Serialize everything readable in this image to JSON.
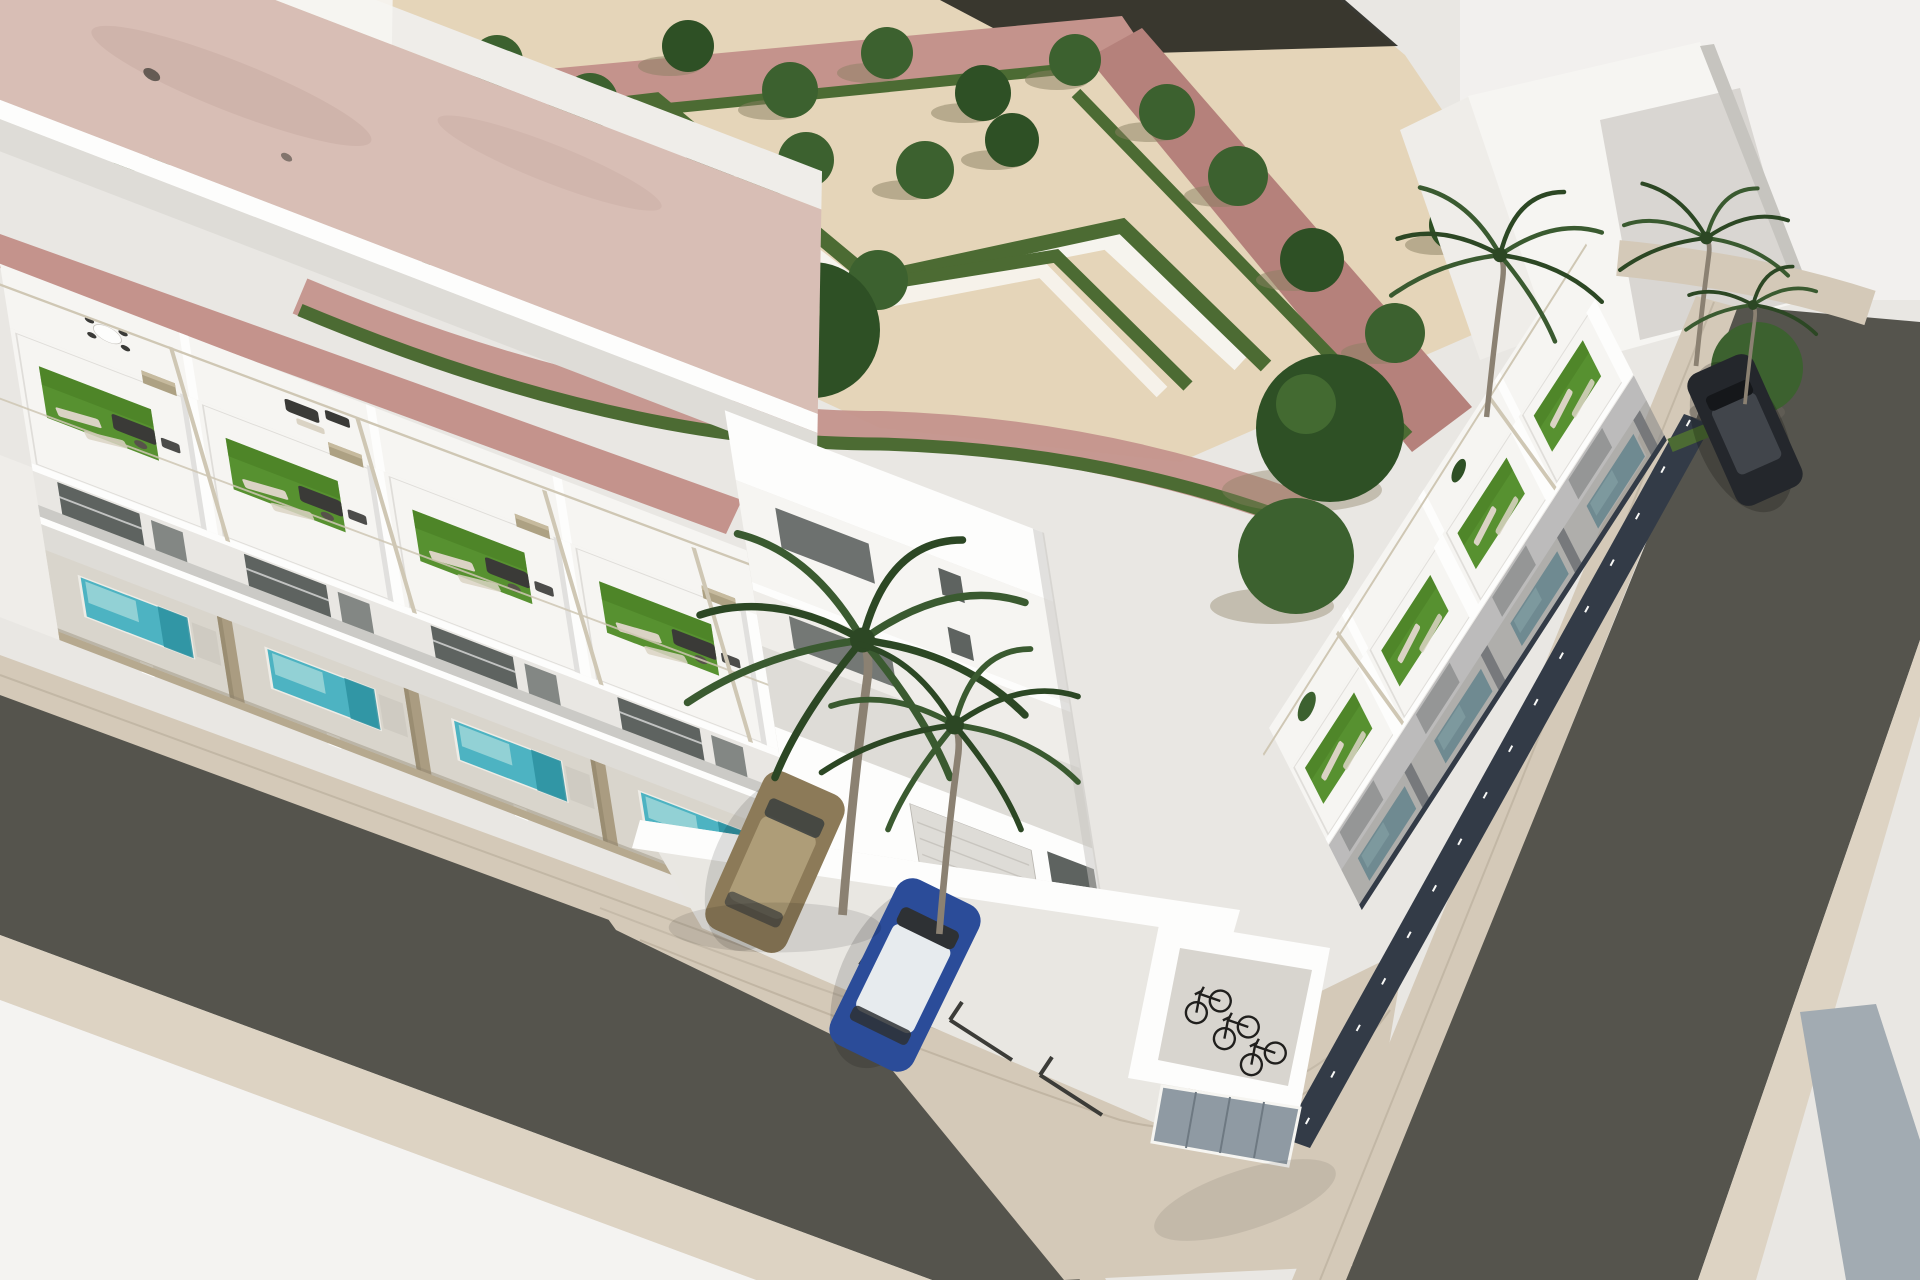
{
  "scene": {
    "title": "Aerial 3D render - new-build white townhouses on a corner plot",
    "type": "architectural visualization",
    "view": "elevated three-quarter aerial view",
    "setting": "Modern Mediterranean residential development beside a landscaped public garden",
    "elements": [
      "sand-coloured plaza with formal garden of zig-zag clipped hedges",
      "white garden paths and rows of ornamental trees",
      "pink paved walkways framing the park",
      "neighbouring building with dusty-pink flat roof",
      "row of four white townhouses along the lower street",
      "corner townhouse with double-height facade and garage",
      "row of four white townhouses along the right street",
      "rooftop solarium terraces with artificial turf, loungers and pergolas",
      "private turquoise plunge pools behind tan slatted fences",
      "palm trees in the corner patio and along the right street",
      "asphalt streets meeting at a rounded paved corner",
      "off-street parking court with brown and blue cars",
      "bicycle shelter with three bicycles and grey utility doors",
      "dark car parked on the upper right street"
    ],
    "counts": {
      "townhouse_units": 9,
      "rooftop_terraces": 9,
      "plunge_pools": 8,
      "park_trees": 23,
      "palm_trees": 5,
      "parked_cars": 3,
      "bicycles": 3
    }
  },
  "colors": {
    "background": "#E9E7E3",
    "corner_white": "#F4F3F1",
    "sand": "#E5D5B9",
    "band_dark": "#26261F",
    "path_pink": "#C4938C",
    "path_pink_dark": "#B5817B",
    "garden_path": "#F7F5F0",
    "hedge": "#4C6B33",
    "tree": "#3C612F",
    "tree_dark": "#2E5025",
    "trunk": "#6B5C44",
    "roof_pink": "#D8BEB5",
    "roof_pink_shade": "#C8ABA2",
    "wall_bright": "#FDFDFC",
    "wall_white": "#F6F5F2",
    "wall_light": "#EFEDE9",
    "wall_shade": "#DEDCD7",
    "wall_dark": "#C6C4BF",
    "glass": "#5E6360",
    "glass_light": "#838784",
    "turf": "#579130",
    "turf_shade": "#477C22",
    "furniture_dark": "#3A3A37",
    "furniture_cream": "#DAD3C4",
    "table_brown": "#57524A",
    "pergola": "#CFC7B4",
    "chimney": "#ADA183",
    "chimney_top": "#C6BA9E",
    "pool": "#52C2D7",
    "pool_light": "#A5E6F0",
    "pool_step": "#2F9CB2",
    "pool_shade": "#2E7E94",
    "pool_shade_light": "#5FB3C4",
    "deck": "#EDEAE4",
    "deck_shade": "#CFCCC5",
    "fence_tan": "#B6A98F",
    "fence_navy": "#333B47",
    "road": "#55544D",
    "sidewalk": "#D4C9B8",
    "sidewalk_far": "#DDD3C3",
    "strip_gray": "#A2ABB2",
    "court": "#E9E7E2",
    "court_line": "#3C3C38",
    "car_blue": "#2B4C99",
    "car_blue_roof": "#E7EBEE",
    "car_brown": "#8C7A58",
    "car_brown_roof": "#AE9D78",
    "car_dark": "#24272C",
    "car_dark_roof": "#41454B",
    "bike": "#201F1D",
    "door_gray": "#8F9AA3",
    "door_line": "#6E7982",
    "palm": "#3A5A30",
    "palm_dark": "#2C4724",
    "palm_trunk": "#8B8172",
    "shadow_navy": "#2B3038"
  }
}
